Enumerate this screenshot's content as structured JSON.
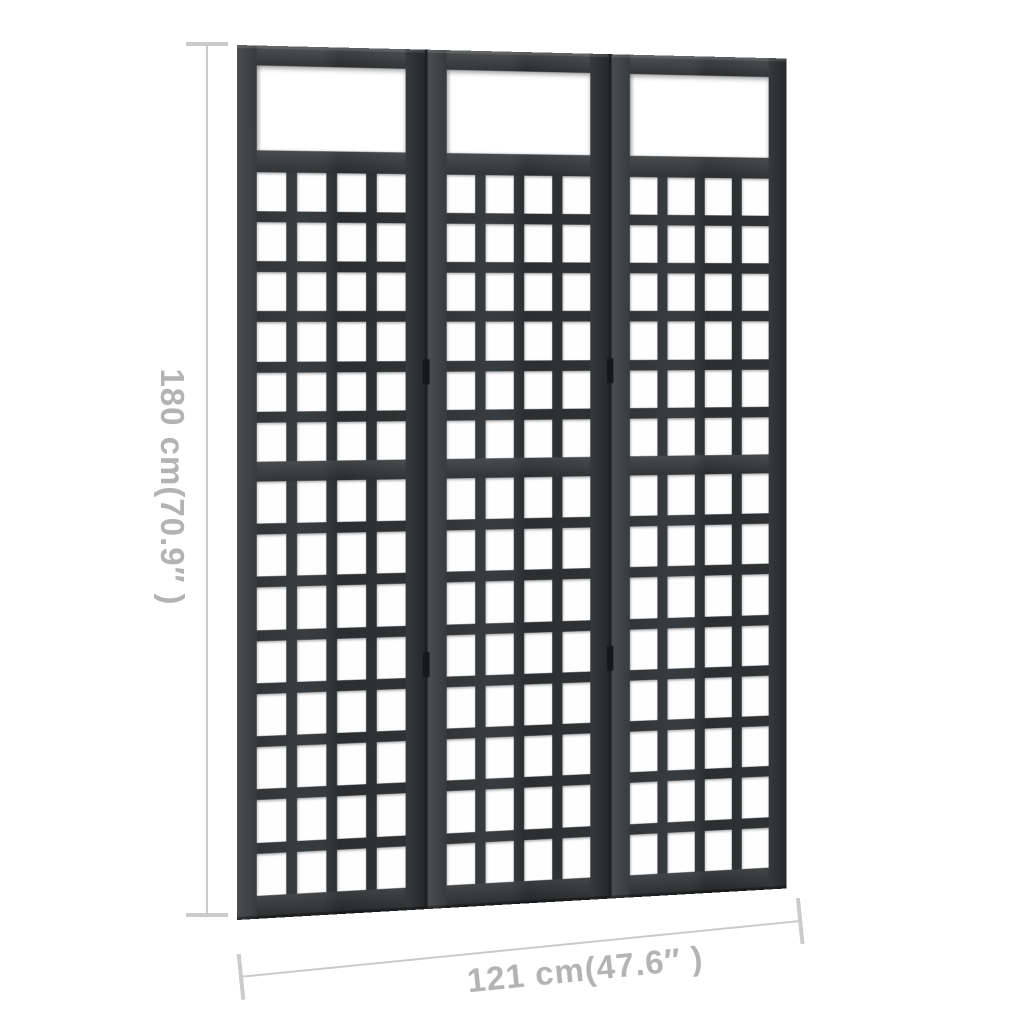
{
  "product": {
    "description": "3-panel dark wooden trellis room divider with top open windows and square lattice grids",
    "structure": {
      "panels": 3,
      "top_window": true,
      "lattice_columns": 4,
      "upper_lattice_rows": 6,
      "lower_lattice_rows": 8,
      "hinges_per_seam": 2
    },
    "colors": {
      "background": "#ffffff",
      "wood_dark": "#26282a",
      "wood_mid": "#393c3e",
      "wood_highlight": "#4a4d4f",
      "dimension_line": "#cbcbcb",
      "dimension_text": "#b3b3b3"
    }
  },
  "dimensions": {
    "height": {
      "label": "180 cm(70.9″ )",
      "value_cm": 180,
      "value_inches": 70.9
    },
    "width": {
      "label": "121 cm(47.6″ )",
      "value_cm": 121,
      "value_inches": 47.6
    }
  }
}
